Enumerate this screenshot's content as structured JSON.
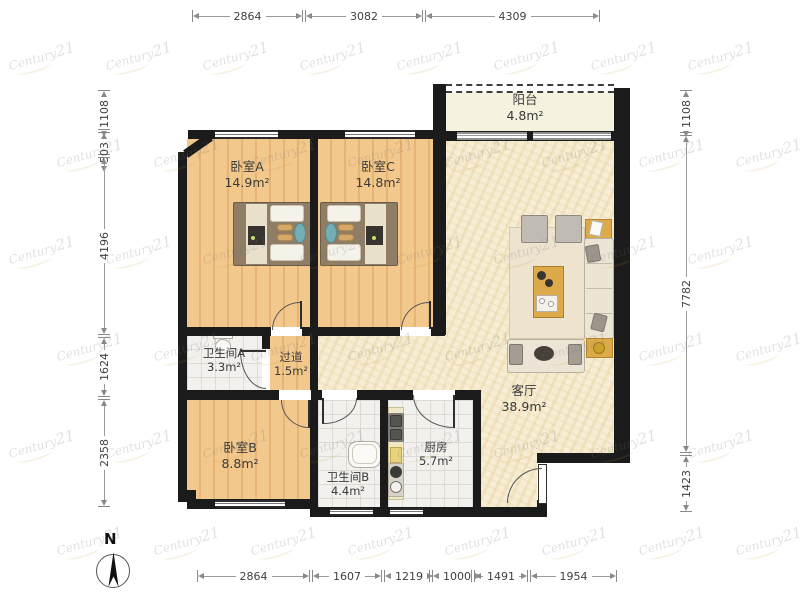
{
  "title": "apartment-floor-plan",
  "watermark": {
    "part1": "Century",
    "part2": "21"
  },
  "compass": {
    "label": "N"
  },
  "rooms": [
    {
      "id": "balcony",
      "name": "阳台",
      "area": "4.8m²"
    },
    {
      "id": "bedroom-a",
      "name": "卧室A",
      "area": "14.9m²"
    },
    {
      "id": "bedroom-c",
      "name": "卧室C",
      "area": "14.8m²"
    },
    {
      "id": "living-room",
      "name": "客厅",
      "area": "38.9m²"
    },
    {
      "id": "bathroom-a",
      "name": "卫生间A",
      "area": "3.3m²"
    },
    {
      "id": "hallway",
      "name": "过道",
      "area": "1.5m²"
    },
    {
      "id": "bedroom-b",
      "name": "卧室B",
      "area": "8.8m²"
    },
    {
      "id": "bathroom-b",
      "name": "卫生间B",
      "area": "4.4m²"
    },
    {
      "id": "kitchen",
      "name": "厨房",
      "area": "5.7m²"
    }
  ],
  "dimensions": {
    "top": [
      "2864",
      "3082",
      "4309"
    ],
    "bottom": [
      "2864",
      "1607",
      "1219",
      "1000",
      "1491",
      "1954"
    ],
    "left": [
      "1108",
      "503",
      "4196",
      "1624",
      "2358"
    ],
    "right": [
      "1108",
      "7782",
      "1423"
    ]
  },
  "colors": {
    "wall": "#1b1b1b",
    "wood1": "#f2c88c",
    "wood2": "#e6b575",
    "living": "#f6edd4",
    "tile": "#f2f1ee",
    "tileLine": "#dddbd5",
    "balcony": "#f5f2df",
    "counter": "#efe7c6",
    "tableWood": "#dca94b",
    "teal": "#74afb5",
    "sofa": "#ece5d6",
    "bedFrame": "#8f7d66"
  }
}
